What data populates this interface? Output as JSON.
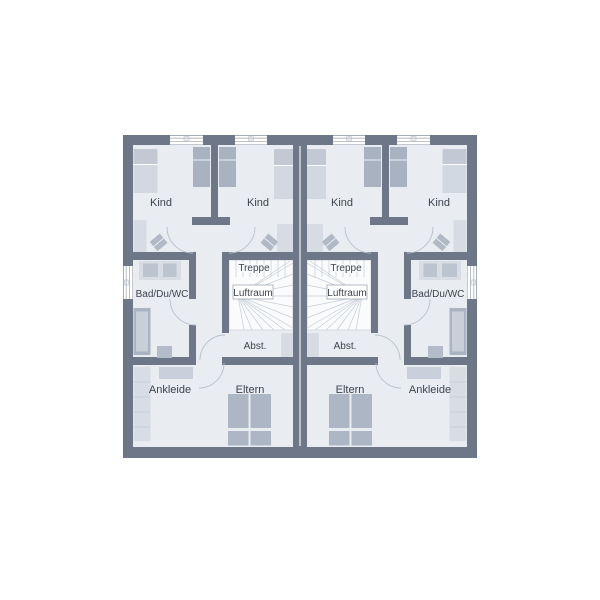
{
  "floorplan": {
    "type": "residential-upper-floor-plan-duplex",
    "labels": {
      "kind": "Kind",
      "treppe": "Treppe",
      "luftraum": "Luftraum",
      "abstellraum": "Abst.",
      "bad": "Bad/Du/WC",
      "ankleide": "Ankleide",
      "eltern": "Eltern"
    },
    "units": [
      {
        "side": "left",
        "rooms": [
          "Kind",
          "Kind",
          "Bad/Du/WC",
          "Treppe",
          "Luftraum",
          "Abst.",
          "Ankleide",
          "Eltern"
        ]
      },
      {
        "side": "right",
        "rooms": [
          "Kind",
          "Kind",
          "Bad/Du/WC",
          "Treppe",
          "Luftraum",
          "Abst.",
          "Ankleide",
          "Eltern"
        ]
      }
    ],
    "colors": {
      "background": "#ffffff",
      "wall": "#6d7787",
      "floor": "#e9edf2",
      "furniture_light": "#d5dae3",
      "furniture_medium": "#aab3c1",
      "stair_area": "#fafbfd",
      "stair_lines": "#c6ccd6",
      "door_arc": "#b9c0cb",
      "label_text": "#3d434f"
    }
  }
}
